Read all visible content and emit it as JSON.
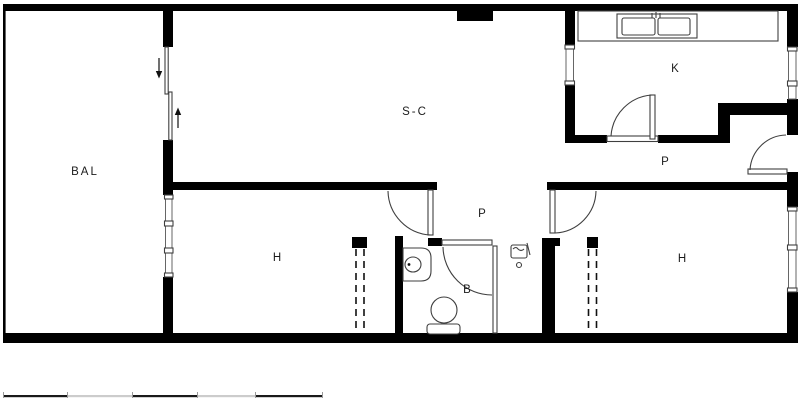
{
  "plan": {
    "balcony_label": "BAL",
    "living_label": "S-C",
    "kitchen_label": "K",
    "entry_hall_label": "P",
    "corridor_label": "P",
    "bedroom_left_label": "H",
    "bedroom_right_label": "H",
    "bathroom_label": "B"
  },
  "colors": {
    "wall": "#000000",
    "line": "#3f3f3f",
    "glazing": "#666666",
    "label": "#1b1b1b",
    "scale_dark": "#1a1a1a",
    "scale_light": "#cccccc"
  }
}
